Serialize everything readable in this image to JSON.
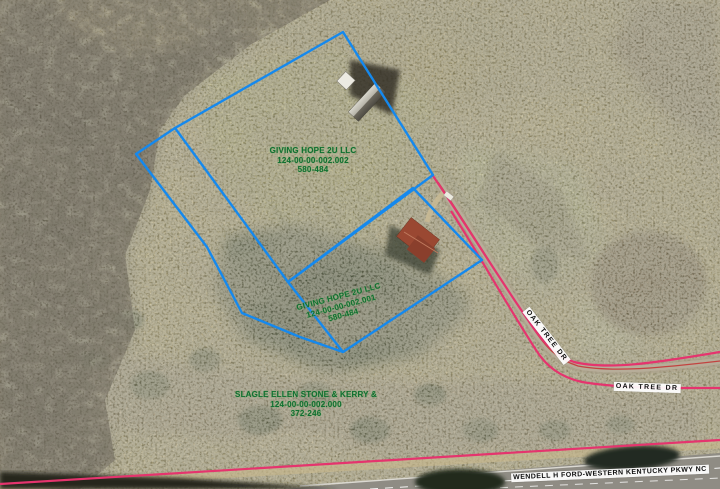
{
  "map": {
    "parcel_labels": [
      {
        "owner": "GIVING HOPE 2U LLC",
        "parcel_id": "124-00-00-002.002",
        "deed_ref": "580-484"
      },
      {
        "owner": "GIVING HOPE 2U LLC",
        "parcel_id": "124-00-00-002.001",
        "deed_ref": "580-484"
      },
      {
        "owner": "SLAGLE ELLEN STONE & KERRY &",
        "parcel_id": "124-00-00-002.000",
        "deed_ref": "372-246"
      }
    ],
    "road_labels": [
      {
        "name": "OAK TREE DR"
      },
      {
        "name": "OAK TREE DR"
      },
      {
        "name": "WENDELL H FORD-WESTERN KENTUCKY PKWY NC"
      }
    ],
    "colors": {
      "parcel_line": "#1589ee",
      "row_line": "#e5346e",
      "centerline": "#c43030",
      "parcel_text": "#0f7030"
    }
  }
}
